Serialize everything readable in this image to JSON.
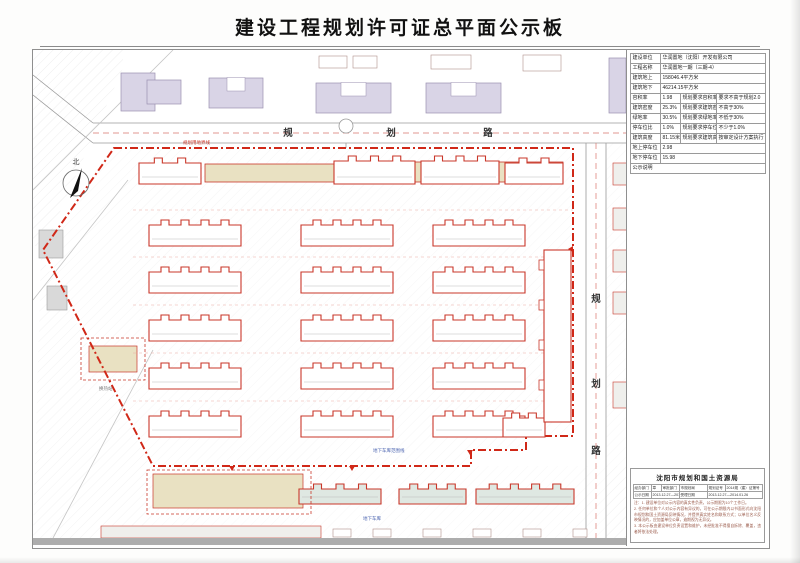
{
  "page": {
    "title": "建设工程规划许可证总平面公示板"
  },
  "info_table": {
    "rows": [
      [
        {
          "t": "建设单位"
        },
        {
          "t": "华润置地（沈阳）开发有限公司",
          "cs": 3
        }
      ],
      [
        {
          "t": "工程名称"
        },
        {
          "t": "华润置地一期（三期-4）",
          "cs": 3
        }
      ],
      [
        {
          "t": "建筑地上"
        },
        {
          "t": "158046.4平方米",
          "cs": 3
        }
      ],
      [
        {
          "t": "建筑地下"
        },
        {
          "t": "46214.15平方米",
          "cs": 3
        }
      ],
      [
        {
          "t": "容积率"
        },
        {
          "t": "1.98"
        },
        {
          "t": "规划要求容积率"
        },
        {
          "t": "要求不高于规划2.0"
        }
      ],
      [
        {
          "t": "建筑密度"
        },
        {
          "t": "25.3%"
        },
        {
          "t": "规划要求建筑密度"
        },
        {
          "t": "不高于30%"
        }
      ],
      [
        {
          "t": "绿地率"
        },
        {
          "t": "30.5%"
        },
        {
          "t": "规划要求绿地率"
        },
        {
          "t": "不低于30%"
        }
      ],
      [
        {
          "t": "停车位比"
        },
        {
          "t": "1.0%"
        },
        {
          "t": "规划要求停车位比"
        },
        {
          "t": "不少于1.0%"
        }
      ],
      [
        {
          "t": "建筑高度"
        },
        {
          "t": "81.15米"
        },
        {
          "t": "规划要求建筑高度"
        },
        {
          "t": "按审定设计方案执行"
        }
      ],
      [
        {
          "t": "地上停车位"
        },
        {
          "t": "2.98",
          "cs": 3
        }
      ],
      [
        {
          "t": "地下停车位"
        },
        {
          "t": "15.98",
          "cs": 3
        }
      ],
      [
        {
          "t": "公示说明",
          "cs": 4
        }
      ]
    ]
  },
  "approval": {
    "header": "沈阳市规划和国土资源局",
    "rows": [
      [
        {
          "t": "经办部门"
        },
        {
          "t": "章"
        },
        {
          "t": "审批部门"
        },
        {
          "t": "市规划局"
        },
        {
          "t": "规划证号"
        },
        {
          "t": "2014规（建）证第号"
        }
      ],
      [
        {
          "t": "公示日期"
        },
        {
          "t": "2013.12.27—2014.01.09",
          "cs": 2
        },
        {
          "t": "受理日期"
        },
        {
          "t": "2013.12.27—2014.01.26",
          "cs": 2
        }
      ]
    ],
    "notes": [
      "注：1. 建设单位对公示内容的真实性负责，公示期限为10个工作日。",
      "2. 任何单位和个人对公示内容有异议的，可在公示期限内以书面形式向沈阳市规划和国土资源局反映情况，并提供真实姓名和联系方式；以单位名义反映情况的，应加盖单位公章，逾期视为无异议。",
      "3. 本公示板由建设单位负责设置和维护，未经批准不得擅自拆除、覆盖，违者将依法处理。"
    ]
  },
  "plan": {
    "north": "北",
    "road_top": [
      "规",
      "划",
      "路"
    ],
    "road_right": [
      "规",
      "划",
      "路"
    ],
    "labels": [
      {
        "t": "规划用地界线",
        "x": 150,
        "y": 94,
        "c": "#c9372a"
      },
      {
        "t": "地下车库范围线",
        "x": 340,
        "y": 402,
        "c": "#4a63b0"
      },
      {
        "t": "地下车库",
        "x": 330,
        "y": 470,
        "c": "#4a63b0"
      },
      {
        "t": "换热站",
        "x": 66,
        "y": 340,
        "c": "#777777"
      }
    ],
    "podiums": [
      {
        "x": 172,
        "y": 114,
        "w": 132,
        "h": 18
      },
      {
        "x": 301,
        "y": 112,
        "w": 229,
        "h": 20
      }
    ],
    "buildings": [
      {
        "x": 106,
        "y": 108,
        "w": 62,
        "h": 26,
        "f": "w"
      },
      {
        "x": 301,
        "y": 106,
        "w": 81,
        "h": 28,
        "f": "w"
      },
      {
        "x": 388,
        "y": 106,
        "w": 78,
        "h": 28,
        "f": "w"
      },
      {
        "x": 472,
        "y": 108,
        "w": 58,
        "h": 26,
        "f": "w"
      },
      {
        "x": 116,
        "y": 170,
        "w": 92,
        "h": 26,
        "f": "w"
      },
      {
        "x": 268,
        "y": 170,
        "w": 92,
        "h": 26,
        "f": "w"
      },
      {
        "x": 400,
        "y": 170,
        "w": 92,
        "h": 26,
        "f": "w"
      },
      {
        "x": 116,
        "y": 217,
        "w": 92,
        "h": 26,
        "f": "w"
      },
      {
        "x": 268,
        "y": 217,
        "w": 92,
        "h": 26,
        "f": "w"
      },
      {
        "x": 400,
        "y": 217,
        "w": 92,
        "h": 26,
        "f": "w"
      },
      {
        "x": 116,
        "y": 265,
        "w": 92,
        "h": 26,
        "f": "w"
      },
      {
        "x": 268,
        "y": 265,
        "w": 92,
        "h": 26,
        "f": "w"
      },
      {
        "x": 400,
        "y": 265,
        "w": 92,
        "h": 26,
        "f": "w"
      },
      {
        "x": 116,
        "y": 313,
        "w": 92,
        "h": 26,
        "f": "w"
      },
      {
        "x": 268,
        "y": 313,
        "w": 92,
        "h": 26,
        "f": "w"
      },
      {
        "x": 400,
        "y": 313,
        "w": 92,
        "h": 26,
        "f": "w"
      },
      {
        "x": 116,
        "y": 361,
        "w": 92,
        "h": 26,
        "f": "w"
      },
      {
        "x": 268,
        "y": 361,
        "w": 92,
        "h": 26,
        "f": "w"
      },
      {
        "x": 400,
        "y": 361,
        "w": 92,
        "h": 26,
        "f": "w"
      },
      {
        "x": 470,
        "y": 363,
        "w": 42,
        "h": 24,
        "f": "w"
      },
      {
        "x": 511,
        "y": 200,
        "w": 27,
        "h": 172,
        "f": "w",
        "plain": true
      },
      {
        "x": 266,
        "y": 434,
        "w": 82,
        "h": 20,
        "f": "g"
      },
      {
        "x": 366,
        "y": 434,
        "w": 67,
        "h": 20,
        "f": "g"
      },
      {
        "x": 443,
        "y": 434,
        "w": 98,
        "h": 20,
        "f": "g"
      }
    ],
    "context": [
      {
        "x": 88,
        "y": 23,
        "w": 34,
        "h": 38,
        "k": "lav"
      },
      {
        "x": 114,
        "y": 30,
        "w": 34,
        "h": 24,
        "k": "lav"
      },
      {
        "x": 176,
        "y": 28,
        "w": 54,
        "h": 30,
        "k": "lavU"
      },
      {
        "x": 283,
        "y": 33,
        "w": 75,
        "h": 30,
        "k": "lavU"
      },
      {
        "x": 393,
        "y": 33,
        "w": 75,
        "h": 30,
        "k": "lavU"
      },
      {
        "x": 576,
        "y": 8,
        "w": 17,
        "h": 55,
        "k": "lav"
      },
      {
        "x": 286,
        "y": 6,
        "w": 28,
        "h": 12,
        "k": "box"
      },
      {
        "x": 320,
        "y": 6,
        "w": 24,
        "h": 12,
        "k": "box"
      },
      {
        "x": 398,
        "y": 5,
        "w": 40,
        "h": 14,
        "k": "box"
      },
      {
        "x": 490,
        "y": 5,
        "w": 38,
        "h": 16,
        "k": "box"
      },
      {
        "x": 580,
        "y": 113,
        "w": 16,
        "h": 22,
        "k": "lgt"
      },
      {
        "x": 580,
        "y": 158,
        "w": 16,
        "h": 22,
        "k": "lgt"
      },
      {
        "x": 580,
        "y": 200,
        "w": 16,
        "h": 22,
        "k": "lgt"
      },
      {
        "x": 580,
        "y": 242,
        "w": 16,
        "h": 22,
        "k": "lgt"
      },
      {
        "x": 580,
        "y": 332,
        "w": 16,
        "h": 26,
        "k": "lgt"
      },
      {
        "x": 6,
        "y": 180,
        "w": 24,
        "h": 28,
        "k": "gray"
      },
      {
        "x": 14,
        "y": 236,
        "w": 20,
        "h": 24,
        "k": "gray"
      },
      {
        "x": 56,
        "y": 296,
        "w": 48,
        "h": 26,
        "k": "tan"
      },
      {
        "x": 120,
        "y": 424,
        "w": 150,
        "h": 34,
        "k": "tan"
      },
      {
        "x": 68,
        "y": 476,
        "w": 220,
        "h": 12,
        "k": "lgt"
      },
      {
        "x": 300,
        "y": 479,
        "w": 18,
        "h": 8,
        "k": "box"
      },
      {
        "x": 340,
        "y": 479,
        "w": 18,
        "h": 8,
        "k": "box"
      },
      {
        "x": 390,
        "y": 479,
        "w": 18,
        "h": 8,
        "k": "box"
      },
      {
        "x": 440,
        "y": 479,
        "w": 18,
        "h": 8,
        "k": "box"
      },
      {
        "x": 490,
        "y": 479,
        "w": 18,
        "h": 8,
        "k": "box"
      },
      {
        "x": 540,
        "y": 479,
        "w": 14,
        "h": 8,
        "k": "box"
      }
    ],
    "dashed_rects": [
      {
        "x": 48,
        "y": 288,
        "w": 64,
        "h": 42
      },
      {
        "x": 114,
        "y": 420,
        "w": 164,
        "h": 44
      }
    ],
    "colors": {
      "red": "#c9372a",
      "boundary": "#d02818",
      "beige": "#e9e1c2",
      "lavender": "#d9d4e6",
      "gray": "#d9d9d9",
      "green": "#dfe8e2",
      "blue": "#4a63b0",
      "road": "#9a9a9a"
    }
  }
}
